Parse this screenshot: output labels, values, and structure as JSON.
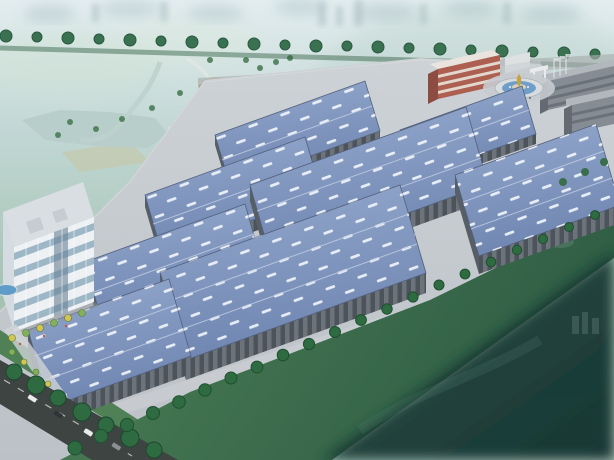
{
  "scene": {
    "alt": "Aerial bird's-eye 3D architectural rendering of an industrial park: eight blue-roofed warehouse halls with white strip skylights arranged in diagonal rows, a white glass office building with landscaped plaza at the lower left, a red-and-white striped administration building, an entrance roundabout with a gold fountain sculpture and grey dormitory blocks at the upper right, tree-lined boundary roads, misty green parkland with a lake and an orange tower behind, and a dark green lawn sweeping across the foreground.",
    "type": "aerial-architectural-rendering",
    "setting": "industrial logistics park surrounded by misty parkland and city"
  },
  "elements": {
    "warehouses": {
      "count": 8,
      "roof": "steel-blue metal roofs with rows of white strip skylights",
      "walls": "grey panel facades with vertical window bays"
    },
    "office_building": {
      "floors": 5,
      "facade": "white frame with blue glass curtain wall",
      "location": "lower left"
    },
    "admin_building": {
      "floors": 3,
      "facade": "red and white horizontal bands",
      "location": "campus entrance, upper right"
    },
    "dormitory_blocks": {
      "count": 2,
      "location": "far right edge"
    },
    "roundabout": {
      "feature": "circular fountain with gold sculpture",
      "location": "main entrance"
    },
    "highrise_tower": {
      "color": "orange",
      "location": "parkland, upper left"
    },
    "vehicles": {
      "count": 4,
      "location": "boulevard at lower-left corner"
    },
    "landscape": {
      "boundary": "rows of perimeter trees",
      "foreground": "lawn fading into dark teal",
      "background": "misty cityscape, lake and fields"
    }
  },
  "palette": {
    "sky_top": "#e3edef",
    "sky_mid": "#c0d6d3",
    "park_green": "#a3c2b0",
    "mist_teal": "#a9c6bb",
    "roof_light": "#95a9cd",
    "roof_dark": "#6f86b1",
    "skylight": "#f3f7fb",
    "roof_trim": "#52607c",
    "wall": "#6d737a",
    "wall_dark": "#4c535a",
    "wall_end": "#575e66",
    "ground": "#bcc1c7",
    "ground_light": "#cdd2d6",
    "road_dark": "#3e4442",
    "lawn": "#4e8156",
    "lawn_far": "#2f5d45",
    "overlay": "#1a453f",
    "overlay_deep": "#0e2b28",
    "tree": "#2e6b40",
    "tree_dark": "#1f4f30",
    "tree_far": "#3a7150",
    "tree_yellow": "#d4c454",
    "tree_lime": "#83b05c",
    "lake": "#b7cdca",
    "field_tan": "#c6c4a2",
    "pool": "#5f9dc8",
    "water_ring": "#6f9fc8",
    "office_frame": "#eef1f3",
    "office_glass": "#9db7c7",
    "office_glass_dark": "#6b8296",
    "admin_red": "#ad5f50",
    "admin_red_dark": "#8d4c41",
    "admin_white": "#e9e5de",
    "dorm": "#868c93",
    "dorm_dark": "#646a72",
    "dorm_roof": "#b2b7bd",
    "tower_orange": "#cf8f44",
    "tower_orange_dark": "#b5722f",
    "gold": "#c9a23f",
    "white": "#e8ebec",
    "car_light": "#e8eaec",
    "car_dark": "#2f3438",
    "car_grey": "#8a9094"
  }
}
